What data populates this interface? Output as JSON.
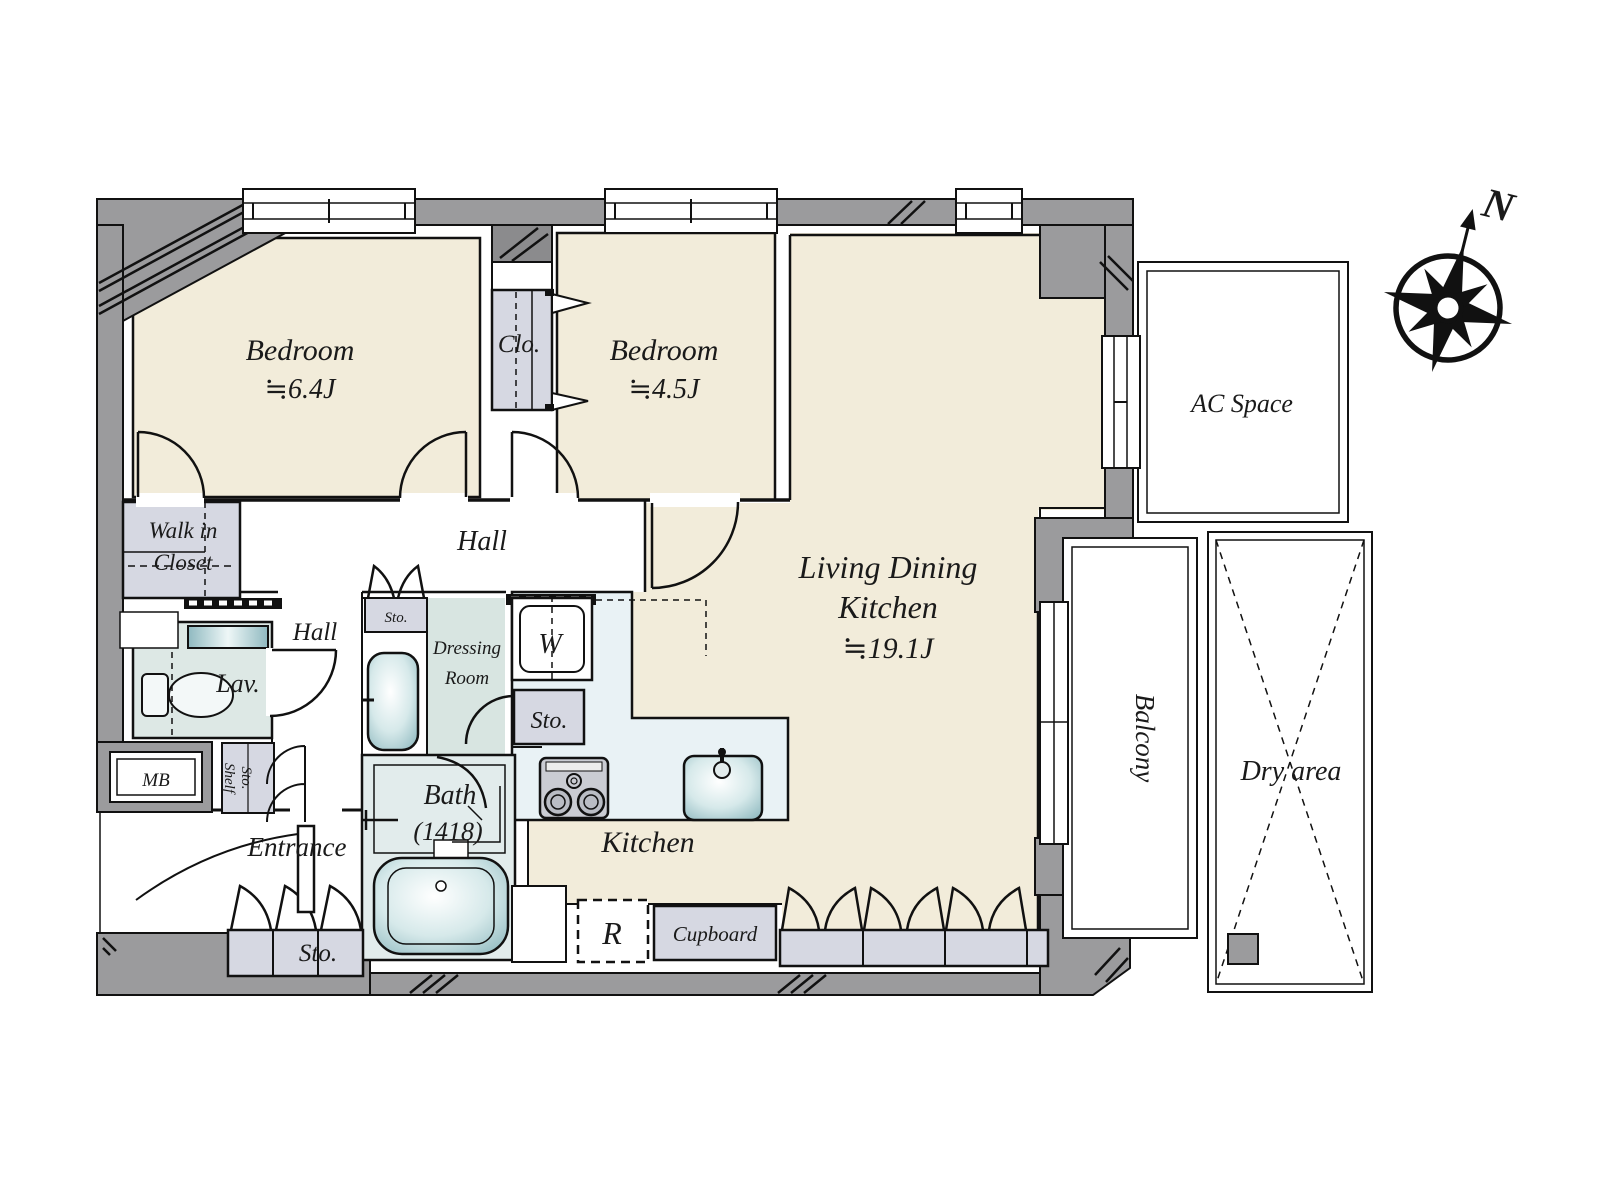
{
  "title": "Apartment floor plan 2LDK",
  "compass": {
    "north": "N"
  },
  "rooms": {
    "bedroom1": {
      "name": "Bedroom",
      "size": "≒6.4J"
    },
    "bedroom2": {
      "name": "Bedroom",
      "size": "≒4.5J"
    },
    "ldk": {
      "name_line1": "Living Dining",
      "name_line2": "Kitchen",
      "size": "≒19.1J"
    },
    "kitchen": {
      "name": "Kitchen"
    },
    "bath": {
      "name": "Bath",
      "size": "(1418)"
    },
    "entrance": {
      "name": "Entrance"
    },
    "hall_upper": {
      "name": "Hall"
    },
    "hall_lower": {
      "name": "Hall"
    },
    "lav": {
      "name": "Lav."
    },
    "dressing_room": {
      "line1": "Dressing",
      "line2": "Room"
    },
    "walk_in_closet": {
      "line1": "Walk in",
      "line2": "Closet"
    }
  },
  "storage": {
    "clo": "Clo.",
    "sto_dressing": "Sto.",
    "sto_hall": "Sto.",
    "sto_entrance": "Sto.",
    "sto_shelf": {
      "line1": "Sto.",
      "line2": "Shelf"
    },
    "cupboard": "Cupboard"
  },
  "appliances": {
    "washing_machine": "W",
    "refrigerator": "R"
  },
  "outdoor": {
    "balcony": "Balcony",
    "dry_area": "Dry area",
    "ac_space": "AC Space"
  },
  "utility": {
    "meter_box": "MB"
  },
  "colors": {
    "wall_gray": "#9b9b9d",
    "pier_gray": "#8b8b8d",
    "room_cream": "#f2ecda",
    "kitchen_blue": "#e9f2f5",
    "closet_gray": "#d6d8e2",
    "dressing_green": "#d8e5e1",
    "bath_blue": "#e2ecec",
    "lav_green": "#dde8e5",
    "fixture_teal": "#93bcc2",
    "line_black": "#111111"
  }
}
